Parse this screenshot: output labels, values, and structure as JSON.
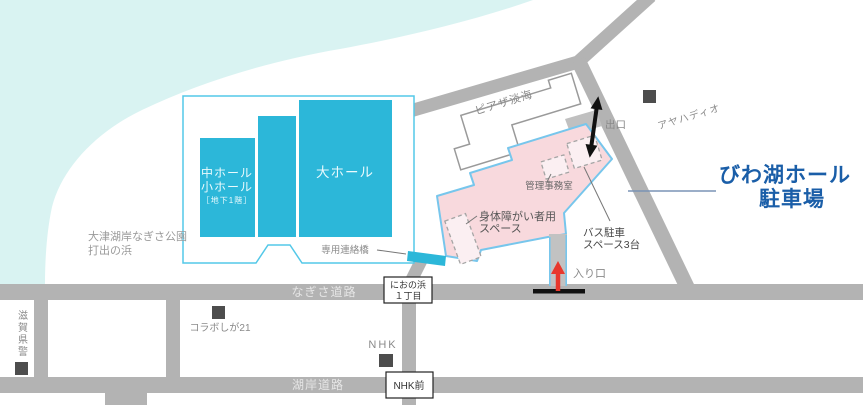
{
  "colors": {
    "lake": "#d9f3f2",
    "road": "#b3b3b3",
    "hall_cyan": "#2cb7d9",
    "hall_border": "#54c8e8",
    "parking_fill": "#f8d9dd",
    "parking_border": "#77c6ec",
    "title_blue": "#1a5ea8",
    "arrow_red": "#e8382d",
    "marker_square": "#4d4d4d"
  },
  "hall": {
    "large": "大ホール",
    "medium": "中ホール",
    "small": "小ホール",
    "basement": "［地下1階］",
    "bridge": "専用連絡橋"
  },
  "park": {
    "line1": "大津湖岸なぎさ公園",
    "line2": "打出の浜"
  },
  "piazza": {
    "label": "ピアザ淡海"
  },
  "parking": {
    "title1": "びわ湖ホール",
    "title2": "駐車場",
    "admin": "管理事務室",
    "disabled1": "身体障がい者用",
    "disabled2": "スペース",
    "bus1": "バス駐車",
    "bus2": "スペース3台",
    "exit": "出口",
    "entrance": "入り口"
  },
  "pois": {
    "ayaha": "アヤハディオ",
    "police": "滋賀県警",
    "collabo": "コラボしが21",
    "nhk": "NHK"
  },
  "roads": {
    "nagisa": "なぎさ道路",
    "kogan": "湖岸道路",
    "stop_nhk": "NHK前",
    "stop_niono1": "におの浜",
    "stop_niono2": "１丁目"
  }
}
